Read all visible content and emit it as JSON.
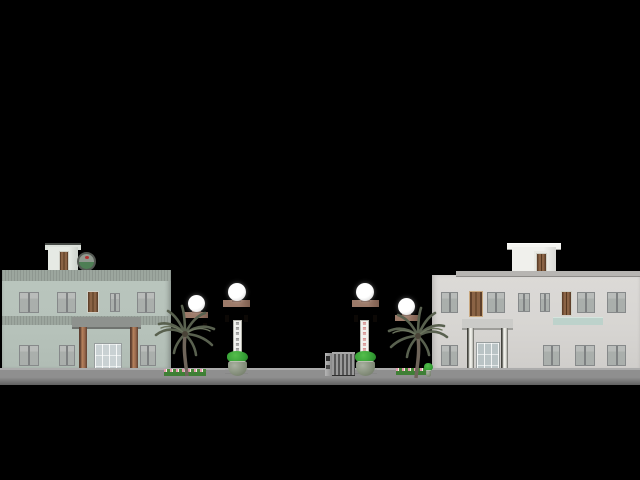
{
  "scene": {
    "description": "Night-time architectural elevation rendering: compound entrance with two two-storey buildings, four brown gate pillars with globe lamps, vertical name signs, potted plants, palm trees, flower beds and a retractable accordion gate",
    "background": "#000000"
  },
  "colors": {
    "road_top": "#ababab",
    "road_mid": "#8f8f8f",
    "road_dark": "#616161",
    "left_facade": "#b6c2ba",
    "left_band": "#9ca69e",
    "right_facade": "#d7d5d2",
    "right_cap": "#b7b5b2",
    "pillar": "#8f6e5e",
    "pillar_shade": "#6b4d40",
    "lamp_white": "#ffffff",
    "door_brown": "#7a563c",
    "frame_gray": "#86898a",
    "glass_pane": "#aaafac",
    "balcony_teal": "#bdd2cb",
    "foliage_green": "#35a035",
    "pot_stone": "#79836f",
    "palm_frond": "#59614f",
    "palm_trunk": "#6f655a",
    "flower_pink": "#e49aae",
    "flower_white": "#f5efe6",
    "bed_green": "#3f7f35",
    "gate_slat_light": "#9a9a9a",
    "gate_slat_dark": "#565656",
    "emblem_green": "#4e7e54",
    "emblem_gray": "#90998f",
    "emblem_red": "#b23232",
    "sign_bg": "#f2f2ee",
    "sign_left_text": "#3c3c3c",
    "sign_right_text": "#c04040"
  },
  "gate": {
    "left_sign": {
      "text": "≡≡≡≡≡≡"
    },
    "right_sign": {
      "text": "≡≡≡≡≡≡"
    },
    "lamp_count": "4"
  }
}
